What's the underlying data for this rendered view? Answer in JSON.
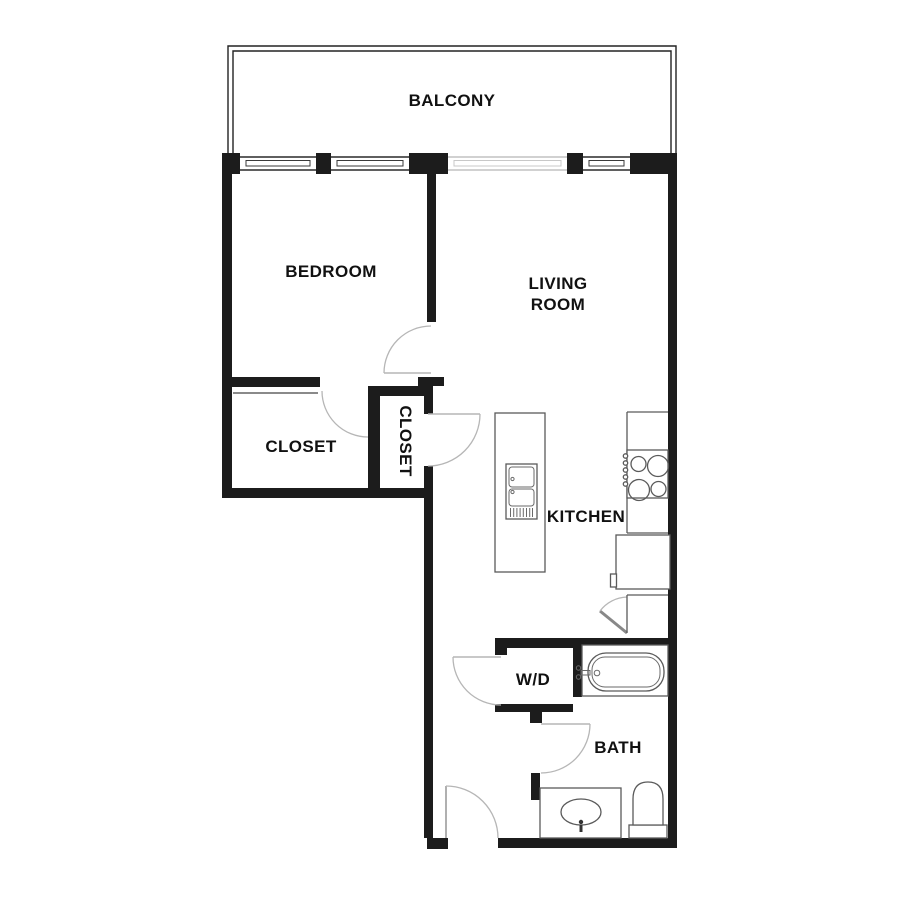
{
  "floor_plan": {
    "rooms": {
      "balcony": {
        "label": "BALCONY"
      },
      "bedroom": {
        "label": "BEDROOM"
      },
      "living_room": {
        "label": "LIVING ROOM",
        "lines": [
          "LIVING",
          "ROOM"
        ]
      },
      "closet_bedroom": {
        "label": "CLOSET",
        "orientation": "horizontal"
      },
      "closet_hall": {
        "label": "CLOSET",
        "orientation": "vertical"
      },
      "kitchen": {
        "label": "KITCHEN"
      },
      "laundry": {
        "label": "W/D"
      },
      "bath": {
        "label": "BATH"
      }
    },
    "fixtures": [
      "kitchen-island-with-double-sink",
      "cooktop-4-burners",
      "refrigerator",
      "pantry-closet",
      "bathtub",
      "vanity-sink",
      "toilet",
      "balcony-windows-and-sliding-door"
    ],
    "colors": {
      "background": "#ffffff",
      "wall": "#1c1c1c",
      "door_swing": "#b6b6b6",
      "window_light": "#c2c2c2",
      "fixture_stroke": "#5a5a5a",
      "label_text": "#111111"
    }
  }
}
